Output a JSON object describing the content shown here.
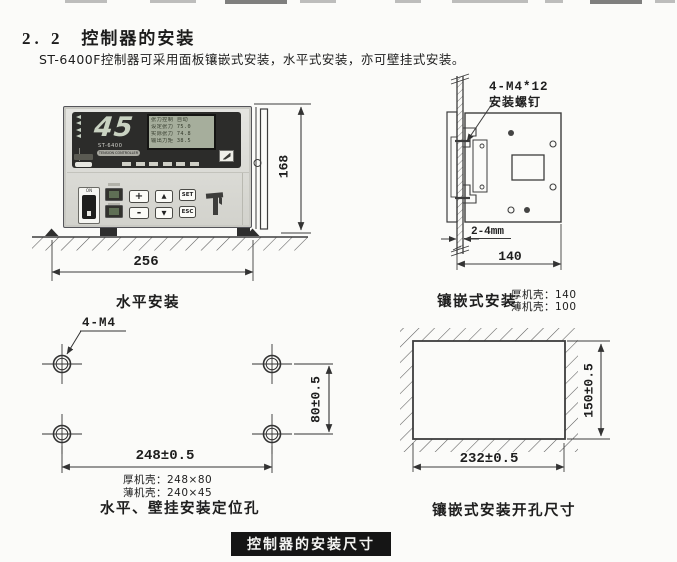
{
  "page": {
    "section_number": "2. 2",
    "section_title": "控制器的安装",
    "intro": "ST-6400F控制器可采用面板镶嵌式安装，水平式安装，亦可壁挂式安装。",
    "footer_banner": "控制器的安装尺寸"
  },
  "controller": {
    "model": "ST-6400",
    "model_sub": "TENSION CONTROLLER",
    "display_value": "45",
    "lcd_lines": [
      "张力控制  自动",
      "设定张力  75.0",
      "实际张力  74.8",
      "输出力矩  38.5"
    ],
    "power_label": "ON",
    "buttons": {
      "plus": "+",
      "minus": "-",
      "up": "▲",
      "down": "▼",
      "set": "SET",
      "esc": "ESC"
    }
  },
  "horizontal_mount": {
    "caption": "水平安装",
    "width_dim": "256",
    "height_dim": "168"
  },
  "panel_mount": {
    "caption": "镶嵌式安装",
    "screw_label_line1": "4-M4*12",
    "screw_label_line2": "安装螺钉",
    "panel_thickness": "2-4mm",
    "depth_dim": "140",
    "note_thick": "厚机壳：140",
    "note_thin": "薄机壳：100"
  },
  "positioning_holes": {
    "caption": "水平、壁挂安装定位孔",
    "hole_label": "4-M4",
    "height_dim": "80±0.5",
    "width_dim": "248±0.5",
    "note_thick": "厚机壳：248×80",
    "note_thin": "薄机壳：240×45"
  },
  "cutout": {
    "caption": "镶嵌式安装开孔尺寸",
    "height_dim": "150±0.5",
    "width_dim": "232±0.5"
  }
}
